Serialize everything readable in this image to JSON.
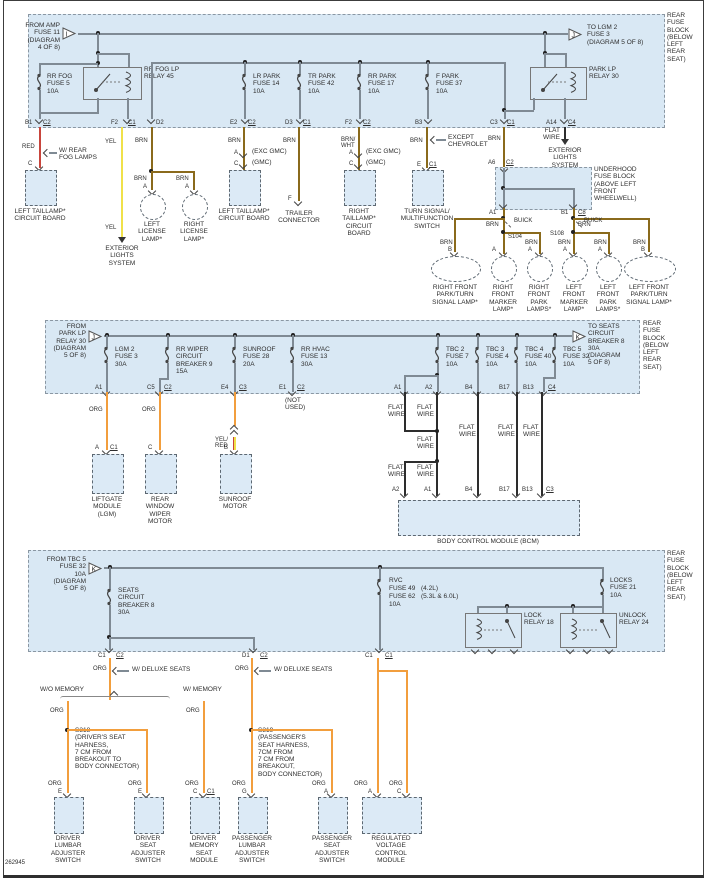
{
  "page": {
    "footer_code": "262945",
    "rear_block_label": "REAR\nFUSE\nBLOCK\n(BELOW\nLEFT\nREAR\nSEAT)"
  },
  "colors": {
    "red_wire": "#c8453c",
    "yellow_wire": "#f0e14a",
    "brown_wire": "#8a6a1c",
    "orange_wire": "#f29e3d",
    "black_wire": "#2d2d2d",
    "gray_wire": "#7f8a94",
    "block_fill": "#d9e8f4"
  },
  "wire": {
    "red": "RED",
    "yel": "YEL",
    "brn": "BRN",
    "brnwht": "BRN/\nWHT",
    "org": "ORG",
    "yelred": "YEL/\nRED"
  },
  "pins": {
    "a": "A",
    "b": "B",
    "c": "C",
    "e": "E",
    "f": "F",
    "g": "G",
    "a1": "A1",
    "a2": "A2",
    "a6": "A6",
    "a14": "A14",
    "b1": "B1",
    "b3": "B3",
    "b4": "B4",
    "b13": "B13",
    "b17": "B17",
    "c1": "C1",
    "c2": "C2",
    "c3": "C3",
    "c4": "C4",
    "c5": "C5",
    "c8": "C8",
    "d1": "D1",
    "d2": "D2",
    "d3": "D3",
    "e1": "E1",
    "e2": "E2",
    "e4": "E4",
    "f2": "F2",
    "s104": "S104",
    "s108": "S108"
  },
  "top": {
    "from_amp": "FROM AMP\nFUSE 11\n(DIAGRAM\n4 OF 8)",
    "tri_in": "I",
    "to_lgm": "TO LGM 2\nFUSE 3\n(DIAGRAM 5 OF 8)",
    "tri_out": "J",
    "rr_fog_fuse": "RR FOG\nFUSE 5\n10A",
    "rr_fog_relay": "RR FOG LP\nRELAY 45",
    "lr_park": "LR PARK\nFUSE 14\n10A",
    "tr_park": "TR PARK\nFUSE 42\n10A",
    "rr_park": "RR PARK\nFUSE 17\n10A",
    "f_park": "F PARK\nFUSE 37\n10A",
    "park_relay": "PARK LP\nRELAY 30",
    "flat_wire": "FLAT\nWIRE"
  },
  "mid": {
    "from_park": "FROM\nPARK LP\nRELAY 30\n(DIAGRAM\n5 OF 8)",
    "tri_in": "J",
    "lgm2": "LGM 2\nFUSE 3\n30A",
    "rr_wiper": "RR WIPER\nCIRCUIT\nBREAKER 9\n15A",
    "sunroof": "SUNROOF\nFUSE 28\n20A",
    "rr_hvac": "RR HVAC\nFUSE 13\n30A",
    "tbc2": "TBC 2\nFUSE 7\n10A",
    "tbc3": "TBC 3\nFUSE 4\n10A",
    "tbc4": "TBC 4\nFUSE 40\n10A",
    "tbc5": "TBC 5\nFUSE 32\n10A",
    "to_seats": "TO SEATS\nCIRCUIT\nBREAKER 8\n30A\n(DIAGRAM\n5 OF 8)",
    "tri_out": "K"
  },
  "bot": {
    "from_tbc": "FROM TBC 5\nFUSE 32\n10A\n(DIAGRAM\n5 OF 8)",
    "tri_in": "K",
    "seats_cb": "SEATS\nCIRCUIT\nBREAKER 8\n30A",
    "rvc": "RVC",
    "fuse49": "FUSE 49",
    "l42": "(4.2L)",
    "fuse62": "FUSE 62",
    "l53": "(5.3L & 6.0L)",
    "amp10": "10A",
    "locks": "LOCKS\nFUSE 21\n10A",
    "lock_relay": "LOCK\nRELAY 18",
    "unlock_relay": "UNLOCK\nRELAY 24"
  },
  "comp": {
    "left_taillamp": "LEFT TAILLAMP*\nCIRCUIT BOARD",
    "right_taillamp": "RIGHT\nTAILLAMP*\nCIRCUIT BOARD",
    "trailer": "TRAILER\nCONNECTOR",
    "left_license": "LEFT\nLICENSE\nLAMP*",
    "right_license": "RIGHT\nLICENSE\nLAMP*",
    "turn_signal": "TURN SIGNAL/\nMULTIFUNCTION\nSWITCH",
    "underhood": "UNDERHOOD\nFUSE BLOCK\n(ABOVE LEFT\nFRONT WHEELWELL)",
    "exterior": "EXTERIOR\nLIGHTS\nSYSTEM",
    "rf_parkturn": "RIGHT FRONT\nPARK/TURN\nSIGNAL LAMP*",
    "rf_marker": "RIGHT\nFRONT\nMARKER\nLAMP*",
    "rf_park": "RIGHT\nFRONT\nPARK\nLAMPS*",
    "lf_marker": "LEFT\nFRONT\nMARKER\nLAMP*",
    "lf_park": "LEFT\nFRONT\nPARK\nLAMPS*",
    "lf_parkturn": "LEFT FRONT\nPARK/TURN\nSIGNAL LAMP*",
    "liftgate": "LIFTGATE\nMODULE\n(LGM)",
    "rear_wiper": "REAR\nWINDOW\nWIPER\nMOTOR",
    "sunroof_motor": "SUNROOF\nMOTOR",
    "bcm": "BODY CONTROL MODULE (BCM)",
    "driver_lumbar": "DRIVER\nLUMBAR\nADJUSTER\nSWITCH",
    "driver_seat": "DRIVER\nSEAT\nADJUSTER\nSWITCH",
    "driver_memory": "DRIVER\nMEMORY\nSEAT\nMODULE",
    "pass_lumbar": "PASSENGER\nLUMBAR\nADJUSTER\nSWITCH",
    "pass_seat": "PASSENGER\nSEAT\nADJUSTER\nSWITCH",
    "rvc_module": "REGULATED\nVOLTAGE\nCONTROL\nMODULE"
  },
  "notes": {
    "w_rear_fog": "W/ REAR\nFOG LAMPS",
    "exc_gmc": "(EXC GMC)",
    "gmc": "(GMC)",
    "except_chev": "EXCEPT\nCHEVROLET",
    "buick": "BUICK",
    "flat_wire": "FLAT\nWIRE",
    "not_used": "(NOT\nUSED)",
    "w_deluxe": "W/ DELUXE SEATS",
    "wo_memory": "W/O MEMORY",
    "w_memory": "W/ MEMORY",
    "s318": "S318\n(DRIVER'S SEAT\nHARNESS,\n7 CM FROM\nBREAKOUT TO\nBODY CONNECTOR)",
    "s319": "S319\n(PASSENGER'S\nSEAT HARNESS,\n7CM FROM\n7 CM FROM\nBREAKOUT,\nBODY CONNECTOR)"
  }
}
